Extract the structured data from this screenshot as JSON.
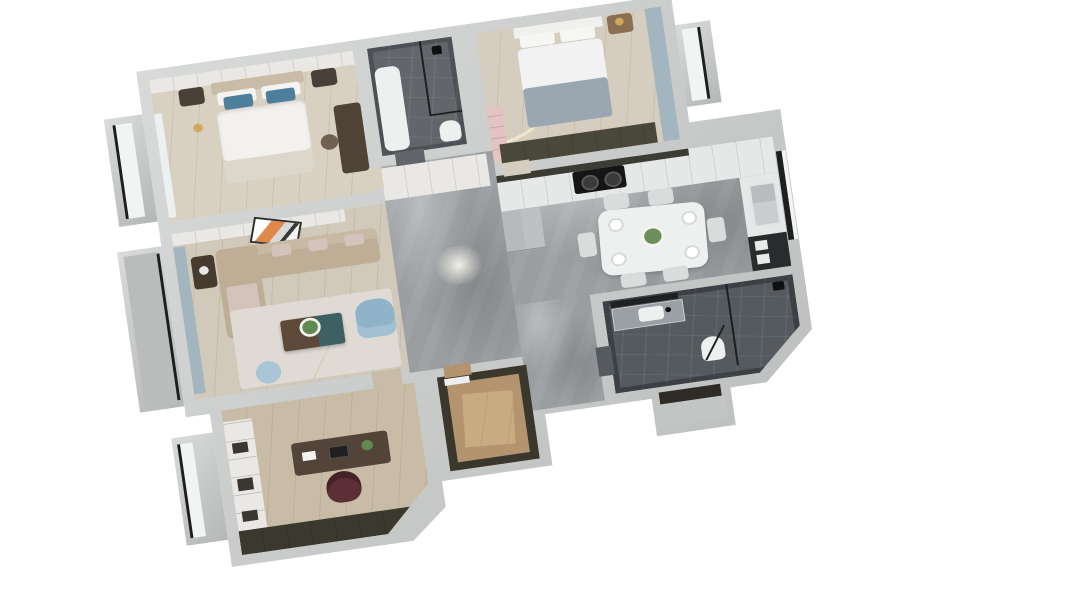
{
  "scene": {
    "type": "3d-floorplan-render-top-view",
    "background": "#ffffff",
    "palette": {
      "wall": "#c9cccb",
      "wall_dark": "#b4b7b6",
      "marble": "#9b9ea1",
      "white_panel": "#e9e8e4",
      "counter": "#e6e8e8",
      "black": "#151515",
      "glass_frame": "#1c1e1f",
      "gold": "#d2a85a",
      "blue_pillow": "#4d7f9d",
      "blue_armchair": "#8fb3c9",
      "blue_curtain": "#a3b6c0",
      "pouf_blue": "#a9c6d6",
      "tan_sofa": "#bfae96",
      "blush_cushion": "#d3c3bb",
      "teal_table": "#3f6063",
      "dark_wood": "#53443a",
      "burgundy_chair": "#5c2e35",
      "orange_art": "#e0884a",
      "pink_shelf": "#e3c3c3",
      "gray_bedding": "#9aa7b0",
      "fridge_gray": "#b6babc",
      "olive_cabinet": "#4a483a",
      "nightstand_wood": "#8a6f52",
      "dark_nightstand": "#4a4038",
      "rug": "#dfdbd4",
      "white_fixture": "#eef0f0",
      "closet_wall": "#3a372d",
      "bath_wall": "#42464a"
    },
    "rooms": [
      {
        "id": "master-bedroom",
        "floor_color": "#d8d0c0",
        "furniture": [
          "wardrobe",
          "double-bed",
          "blue-pillows",
          "nightstand-left",
          "nightstand-right",
          "gold-floor-lamp",
          "dresser-desk",
          "desk-chair",
          "sheer-curtain",
          "bay-window"
        ]
      },
      {
        "id": "bathroom-1",
        "floor_color": "#62666a",
        "furniture": [
          "bathtub-vanity",
          "glass-shower-partition",
          "shower-fixture",
          "toilet"
        ]
      },
      {
        "id": "bedroom-2",
        "floor_color": "#d5cdbf",
        "furniture": [
          "arched-accent-wall",
          "double-bed",
          "wood-nightstand",
          "gold-table-lamp",
          "window-curtains",
          "pink-shelf",
          "olive-wardrobe",
          "bay-window"
        ]
      },
      {
        "id": "kitchen-dining",
        "floor_color": "#9b9ea1",
        "furniture": [
          "upper-cabinets",
          "counter-run",
          "gas-cooktop",
          "fridge",
          "sink-counter",
          "double-sink",
          "kitchen-window",
          "black-pantry-cabinet",
          "dining-table",
          "dining-chairs-x6",
          "plates",
          "table-plant"
        ]
      },
      {
        "id": "hallway",
        "floor_color": "#9b9ea1",
        "furniture": [
          "built-in-cabinets",
          "ceiling-light-flare"
        ]
      },
      {
        "id": "entry",
        "floor_color": "#9b9ea1",
        "furniture": [
          "entry-door",
          "door-step"
        ]
      },
      {
        "id": "living-room",
        "floor_color": "#d1c9ba",
        "furniture": [
          "media-wall-panels",
          "orange-abstract-art",
          "l-shaped-sofa",
          "chaise",
          "side-table",
          "area-rug",
          "two-tone-coffee-table",
          "plant",
          "blue-armchair",
          "blue-pouf",
          "balcony-curtains",
          "balcony"
        ]
      },
      {
        "id": "study",
        "floor_color": "#c9bca6",
        "furniture": [
          "bookshelf",
          "writing-desk",
          "desk-accessories",
          "burgundy-office-chair",
          "low-dark-cabinet",
          "bay-window"
        ]
      },
      {
        "id": "walk-in-closet",
        "floor_color": "#b3946f",
        "furniture": [
          "dark-wardrobe-walls",
          "wood-floor-panel",
          "door-frame"
        ]
      },
      {
        "id": "bathroom-2",
        "floor_color": "#545a5e",
        "furniture": [
          "mirror",
          "vanity-counter",
          "sink",
          "toilet",
          "glass-shower",
          "shower-door",
          "shower-head"
        ]
      },
      {
        "id": "balcony",
        "floor_color": "#b9bcbb",
        "furniture": [
          "sliding-glass-door"
        ]
      }
    ]
  }
}
